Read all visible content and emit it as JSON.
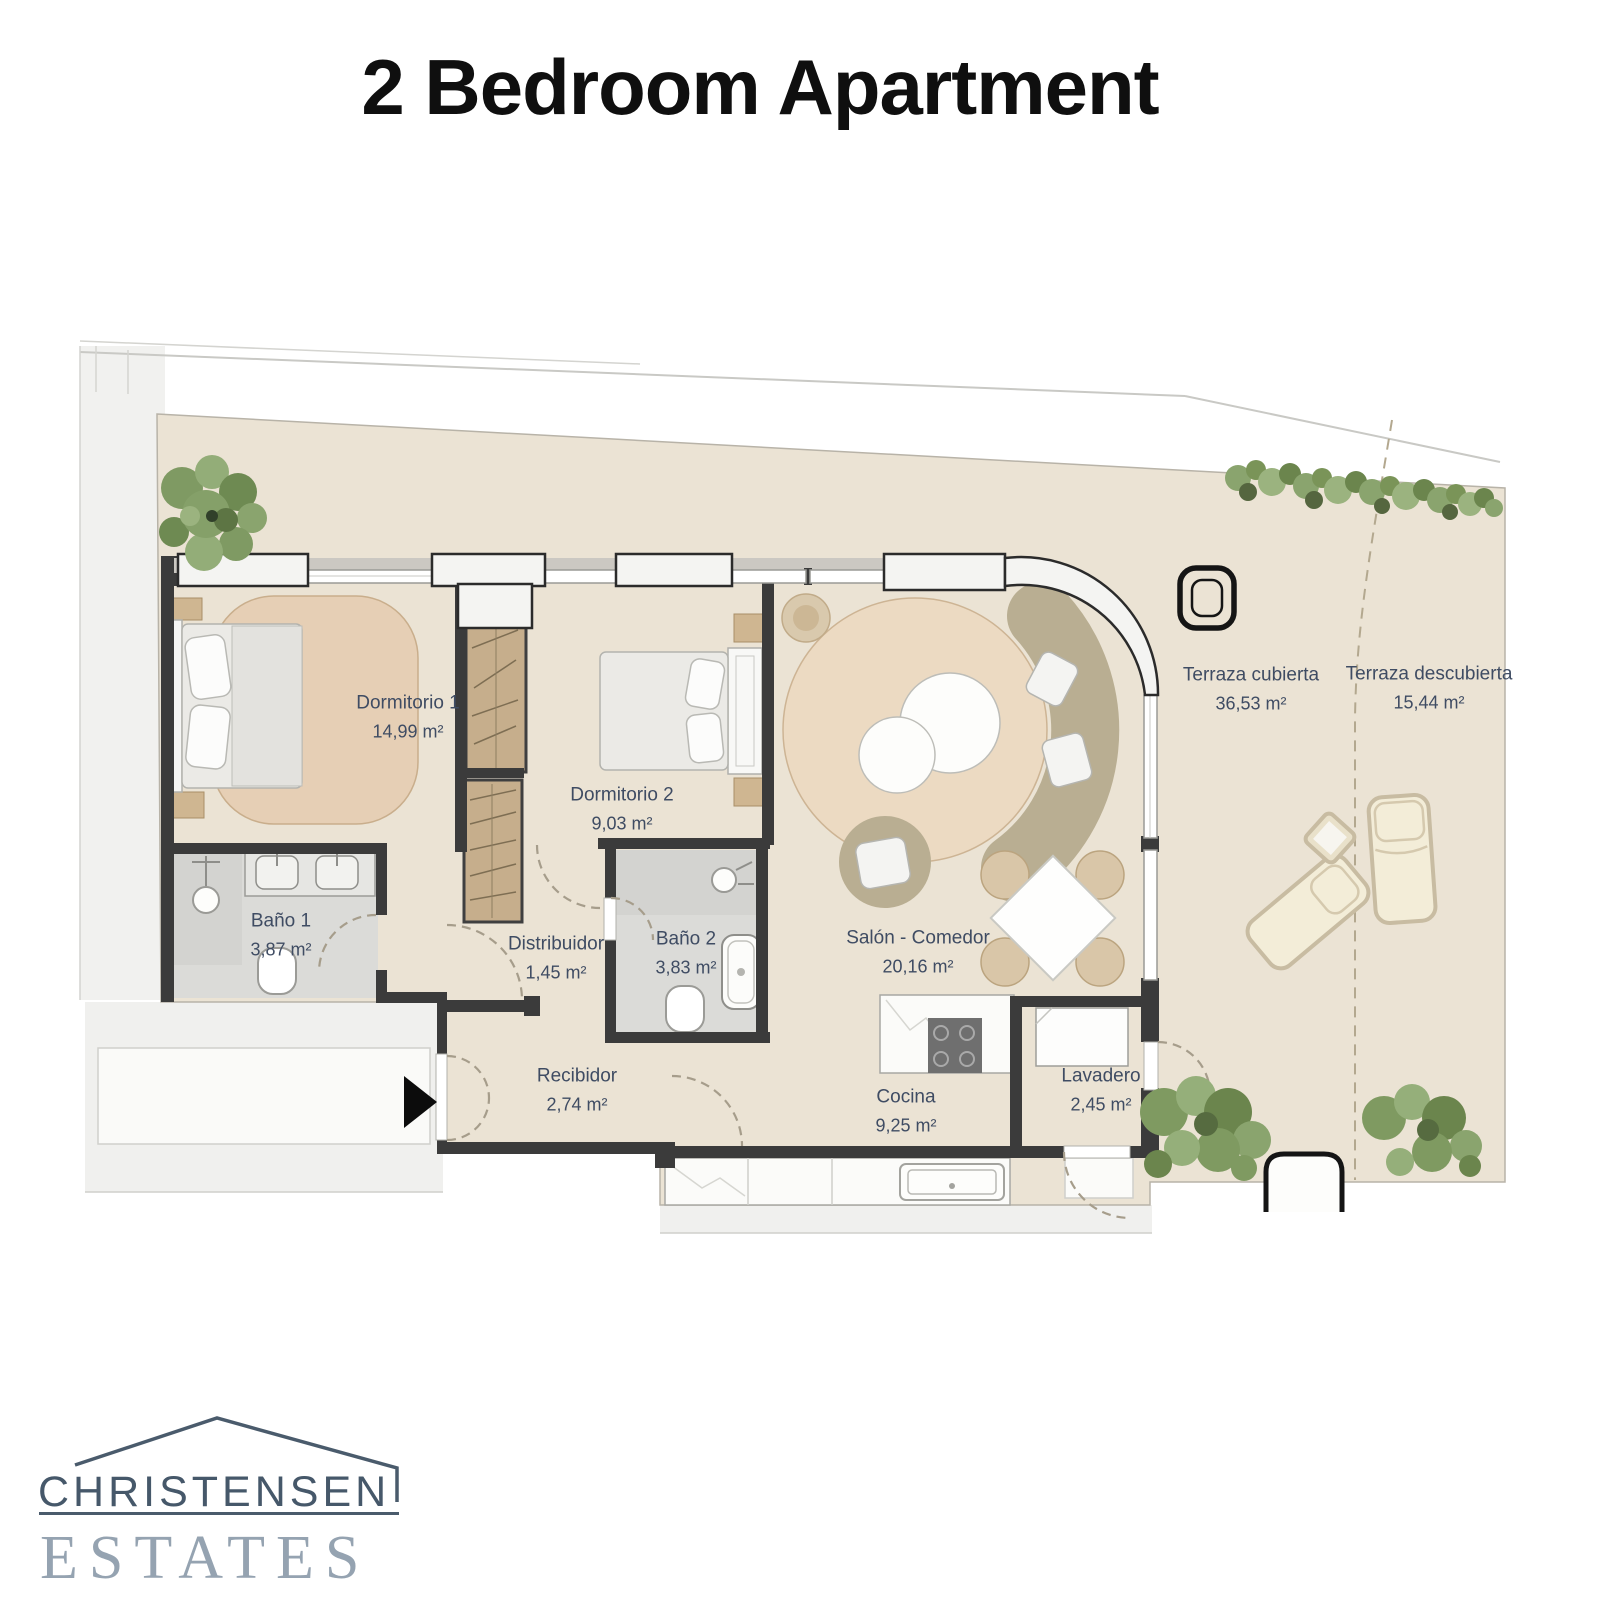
{
  "title": "2 Bedroom Apartment",
  "rooms": [
    {
      "name": "Dormitorio 1",
      "area": "14,99 m²"
    },
    {
      "name": "Dormitorio 2",
      "area": "9,03 m²"
    },
    {
      "name": "Baño 1",
      "area": "3,87 m²"
    },
    {
      "name": "Baño 2",
      "area": "3,83 m²"
    },
    {
      "name": "Distribuidor",
      "area": "1,45 m²"
    },
    {
      "name": "Recibidor",
      "area": "2,74 m²"
    },
    {
      "name": "Salón - Comedor",
      "area": "20,16 m²"
    },
    {
      "name": "Cocina",
      "area": "9,25 m²"
    },
    {
      "name": "Lavadero",
      "area": "2,45 m²"
    },
    {
      "name": "Terraza cubierta",
      "area": "36,53 m²"
    },
    {
      "name": "Terraza descubierta",
      "area": "15,44 m²"
    }
  ],
  "logo": {
    "brand": "CHRISTENSEN",
    "suffix": "ESTATES"
  },
  "icons": {
    "entrance_arrow": "▶"
  },
  "colors": {
    "label_text": "#3f4c63",
    "wall": "#3b3b3b",
    "floor_beige": "#ebe3d4",
    "rug_bedroom": "#e6cfb5",
    "rug_salon": "#ecdac2",
    "bath_floor": "#dbdbd8",
    "wardrobe": "#c6ae8c",
    "sofa": "#b9ae92",
    "greenery": "#7f9a61",
    "logo_dark": "#46586a",
    "logo_light": "#95a3b1",
    "title_text": "#0f0f0f"
  }
}
